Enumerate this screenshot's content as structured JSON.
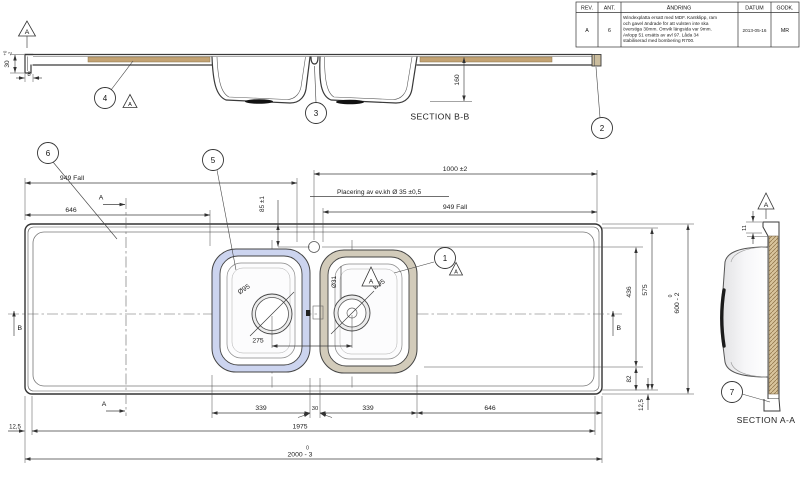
{
  "colors": {
    "mdf_strip": "#c2a273",
    "mdf_hatch_bg": "#d8c49c",
    "left_bowl_rim": "#ccd4ef",
    "right_bowl_rim": "#d2cbba",
    "line": "#3a3a3a"
  },
  "revision_table": {
    "headers": [
      "REV.",
      "ANT.",
      "ÄNDRING",
      "DATUM",
      "GODK."
    ],
    "row": {
      "rev": "A",
      "ant": "6",
      "change_lines": [
        "Windexplatta ersatt med MDF. Kantklipp, ram",
        "och gavel ändrade för att vulsten inte ska",
        "överstiga 30mm. Omvik längsida var 9mm.",
        "Avlopp 51 ersätts av avl 97. Låda 34",
        "stabiliserad med bombering R700."
      ],
      "datum": "2013-05-16",
      "godk": "MR"
    }
  },
  "datum_flag": "A",
  "balloons": {
    "b1": "1",
    "b2": "2",
    "b3": "3",
    "b4": "4",
    "b5": "5",
    "b6": "6",
    "b7": "7"
  },
  "section_bb": {
    "label": "SECTION B-B",
    "edge_height": "30",
    "edge_tol_upper": "+0",
    "edge_tol_lower": "-2",
    "lip_width": "8",
    "bowl_depth": "160"
  },
  "section_aa": {
    "label": "SECTION A-A",
    "rim_height": "11"
  },
  "plan": {
    "fall_left": "949 Fall",
    "fall_right": "949 Fall",
    "left_drainboard": "646",
    "right_span": "1000 ±2",
    "faucet_note": "Placering av ev.kh  Ø 35 ±0,5",
    "faucet_offset": "85 ±1",
    "drain_left_dia": "Ø95",
    "drain_right_dia": "Ø95",
    "overflow_dia": "Ø31",
    "drain_spacing": "275",
    "bowl_left_width": "339",
    "divider_width": "30",
    "bowl_right_width": "339",
    "right_drainboard": "646",
    "inner_length": "1975",
    "total_length": "2000 - 3",
    "total_length_tol": "0",
    "upper_height": "436",
    "inner_width": "575",
    "total_width": "600 - 2",
    "total_width_tol": "0",
    "lower_height": "82",
    "corner_offset_left": "12,5",
    "corner_offset_right": "12,5",
    "marker_a": "A",
    "marker_b": "B"
  }
}
